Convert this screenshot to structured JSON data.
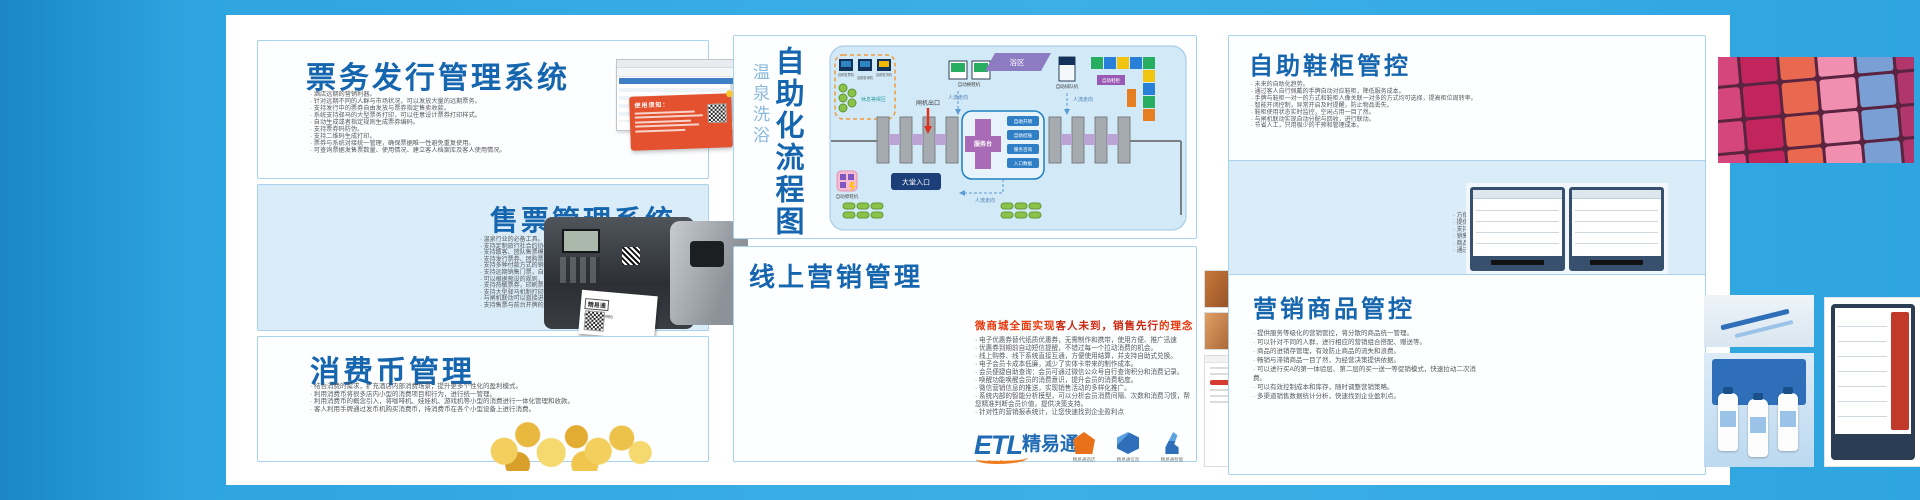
{
  "ticket_issuing": {
    "title": "票务发行管理系统",
    "bullets": [
      "酒店远期的营销利器。",
      "针对远期不同的人群与市场状况，可以发放大量的远期票务。",
      "支持发行中的票券自由发放与票券指定售卖收款。",
      "系统支持驿马的大型票务打印，可以任意设计票券打印样式。",
      "自动生成或者指定规则生成票券编码。",
      "支持票券码防伪。",
      "支持二维码生成打印。",
      "票券与系统对接统一管理，确保票据唯一性避免重复使用。",
      "可查询票据发售票数量、使用情况、建立客人档案库及客人使用情况。"
    ],
    "notice_title": "使用须知："
  },
  "ticket_sales": {
    "title": "售票管理系统",
    "bullets": [
      "温泉行业的必备工具。",
      "支持定制旅行社合约协议价格。",
      "支持散客、团队售票模式。",
      "支持发行票券、团购票券的核销兑换。",
      "支持多种付款方式的销售，现金、会员卡、挂账等。",
      "支持远期销售门票，自动模板规则生成门票编码。",
      "可以根据预设的规则，销售时直接生成门票。",
      "支持热敏票券，印刷票券打印。",
      "支持大型驿马机制打印机。",
      "与闸机联动可以直接进行售票后的门禁授权。",
      "支持售票与前台开牌的联动。"
    ],
    "printer_label_brand": "精易通",
    "printer_label_phone": "024-88680996"
  },
  "coin_mgmt": {
    "title": "消费币管理",
    "bullets": [
      "结合消费的需求，扩充酒店内部消费场景，提升更多个性化的盈利模式。",
      "利用消费币将很多店内小型的消费项目和行为，进行统一管理。",
      "利用消费币的概念引入，将咖啡机、娃娃机、游戏机等小型的消费进行一体化管理和收款。",
      "客人利用手牌通过发币机购买消费币，持消费币在各个小型设备上进行消费。"
    ],
    "card_brand": "Gold",
    "card_brand2": "Coins",
    "card_name": "消费币",
    "offer1_label": "8枚消费币",
    "offer1_price": "16",
    "offer2_label": "20枚消费币",
    "offer2_price": "30",
    "price_unit": "元"
  },
  "flowchart": {
    "title_side": "温泉洗浴",
    "title_main": "自助化流程图",
    "labels": {
      "waiting_zone": "休息等候区",
      "ticket_machine": "自助售票机",
      "query_machine": "自助查询机",
      "vending_machine": "自助售货机",
      "shoe_polisher": "自助擦鞋机",
      "gate_exit": "闸机出口",
      "shoe_change": "自动换鞋机",
      "bath_zone": "浴区",
      "queue_machine": "自助排队机",
      "shoe_cabinet": "自助鞋柜",
      "service_desk": "服务台",
      "chip1": "自助开牌",
      "chip2": "自助结账",
      "chip3": "服务咨询",
      "chip4": "入口数据",
      "flow1": "人流走向",
      "flow2": "人流走向",
      "flow3": "人流走向",
      "lobby_entrance": "大堂入口"
    }
  },
  "online_marketing": {
    "title": "线上营销管理",
    "subtitle_pre": "微商城全面实现",
    "subtitle_em": "客人未到，销售先行",
    "subtitle_post": "的理念",
    "bullets": [
      "电子优惠券替代纸质优惠券，无需制作和携带，使用方便、推广迅速",
      "优惠券到期前自动短信提醒，不错过每一个拉动消费的机会。",
      "线上购券、线下系统直接互通，方便使用结算，并支持自助式兑换。",
      "电子会员卡成本低廉，减少了实体卡带来的制作成本。",
      "会员便捷自助查询：会员可通过微信公众号自行查询积分和消费记录。",
      "唤醒功能唤醒会员的消费意识，提升会员的消费粘度。",
      "微信营销信息的推送，实现销售活动的多样化推广。",
      "系统内部的智能分析模型，可以分析会员消费间隔、次数和消费习惯，帮您精准判断会员价值，提供决策支持。",
      "针对性的营销报表统计，让您快速找到企业盈利点"
    ],
    "brand_etl": "ETL",
    "brand_name": "精易通",
    "brand_tagline": "Easy To Learn",
    "product1": "精易通酒店",
    "product2": "精易通信息",
    "product3": "精易通智能"
  },
  "shoe_cabinet": {
    "title": "自助鞋柜管控",
    "bullets": [
      "未来的自助化趋势。",
      "通过客人自行佩戴的手牌自动对应鞋柜，降低服务成本。",
      "手牌与鞋柜一对一的方式和鞋柜人像关联一对多的方式均可选择，提高柜位周转率。",
      "智能开闭控制，异常开启及时提醒，防止物品丢失。",
      "鞋柜使用状态实时监控，空闲占用一目了然。",
      "与闸机联动实现自动分配与回收，进行联动。",
      "节省人工，只用极少的干预和管理成本。"
    ]
  },
  "vending": {
    "title": "自动售货机",
    "bullets": [
      "方便的自助化购买体验，丰富的商品选择，良好的体验感。",
      "提供饮料、毛巾、泳装、拖鞋等商品售卖，实现24小时营业。",
      "支持手牌、扫码、现金等多种支付方式，统一结算管理。",
      "销售数据与系统实时对接，节省人工，减少营业成本。",
      "商品广告位信息展示，提升二次消费。",
      "通过这样多渠道销售，全自动售卖，无需人工，24小时不间断营业。"
    ]
  },
  "goods_control": {
    "title": "营销商品管控",
    "bullets": [
      "提供服务等级化的营销管控，将分散的商品统一管理。",
      "可以针对不同的人群，进行相应的营销组合搭配、赠送等。",
      "商品的进销存管理，有效防止商品的流失和浪费。",
      "畅销与滞销商品一目了然，为经营决策提供依据。",
      "可以进行买A的第一体验层、第二层的买一送一等促销模式，快速拉动二次消费。",
      "可以有效控制成本和库存，随时调整营销策略。",
      "多渠道销售数据统计分析，快速找到企业盈利点。"
    ]
  }
}
